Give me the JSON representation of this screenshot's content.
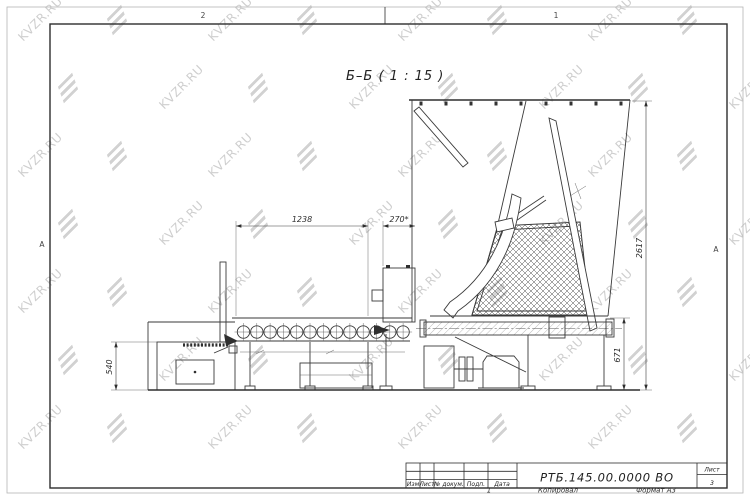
{
  "watermark": {
    "text": "KVZR.RU"
  },
  "view": {
    "label": "Б–Б ( 1 : 15 )"
  },
  "frame": {
    "zone_top_left": "2",
    "zone_top_right": "1",
    "fold_left": "A",
    "fold_right": "A"
  },
  "dimensions": {
    "conveyor_length": "1238",
    "inlet_width": "270*",
    "overall_height": "2617",
    "outlet_height": "671",
    "feeder_height": "540"
  },
  "title_block": {
    "designation": "РТБ.145.00.0000 ВО",
    "col_izm": "Изм",
    "col_list": "Лист",
    "col_doc": "№ докум.",
    "col_podp": "Подп.",
    "col_data": "Дата",
    "sheet_label": "Лист",
    "sheet_number": "3",
    "footer_zone": "1",
    "footer_copy": "Копировал",
    "footer_format": "Формат А3"
  }
}
